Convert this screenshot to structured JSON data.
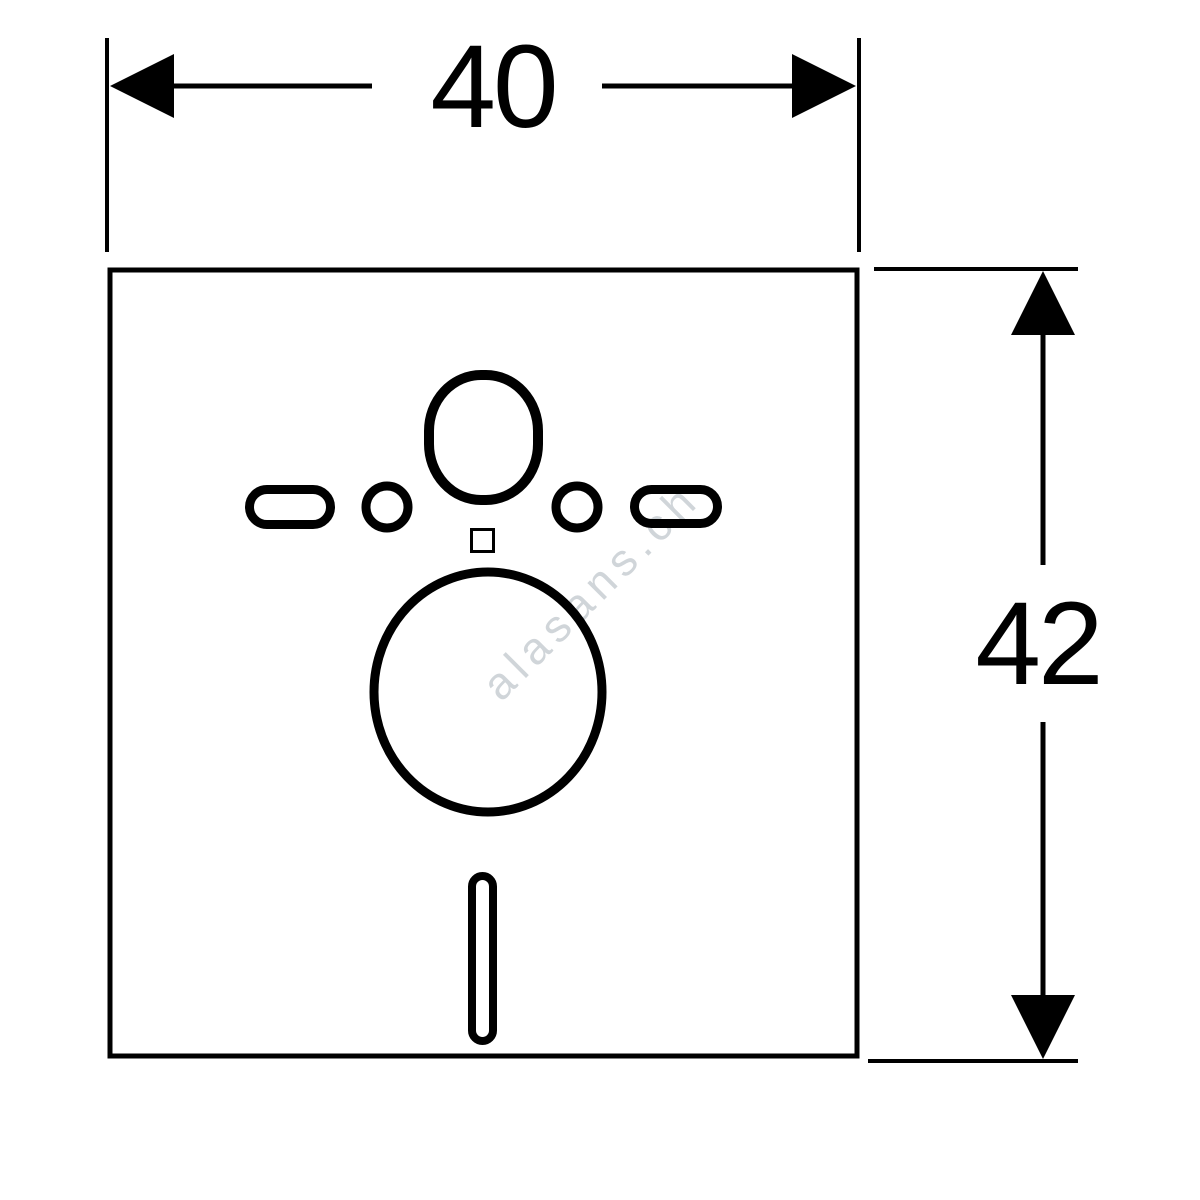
{
  "drawing": {
    "type": "technical dimension drawing",
    "background_color": "#ffffff",
    "line_color": "#000000"
  },
  "dimensions": {
    "width": {
      "value": "40"
    },
    "height": {
      "value": "42"
    }
  },
  "watermark": {
    "text": "alasans.ch",
    "color": "#d0d5d9"
  },
  "shapes": [
    {
      "name": "mat-outline",
      "type": "rectangle"
    },
    {
      "name": "cutout-oval-top",
      "type": "rounded-oval"
    },
    {
      "name": "cutout-slot-left",
      "type": "horizontal-pill"
    },
    {
      "name": "cutout-slot-right",
      "type": "horizontal-pill"
    },
    {
      "name": "cutout-hole-left",
      "type": "circle"
    },
    {
      "name": "cutout-hole-right",
      "type": "circle"
    },
    {
      "name": "cutout-square-small",
      "type": "square"
    },
    {
      "name": "cutout-circle-large",
      "type": "circle"
    },
    {
      "name": "cutout-slot-bottom",
      "type": "vertical-pill"
    }
  ]
}
